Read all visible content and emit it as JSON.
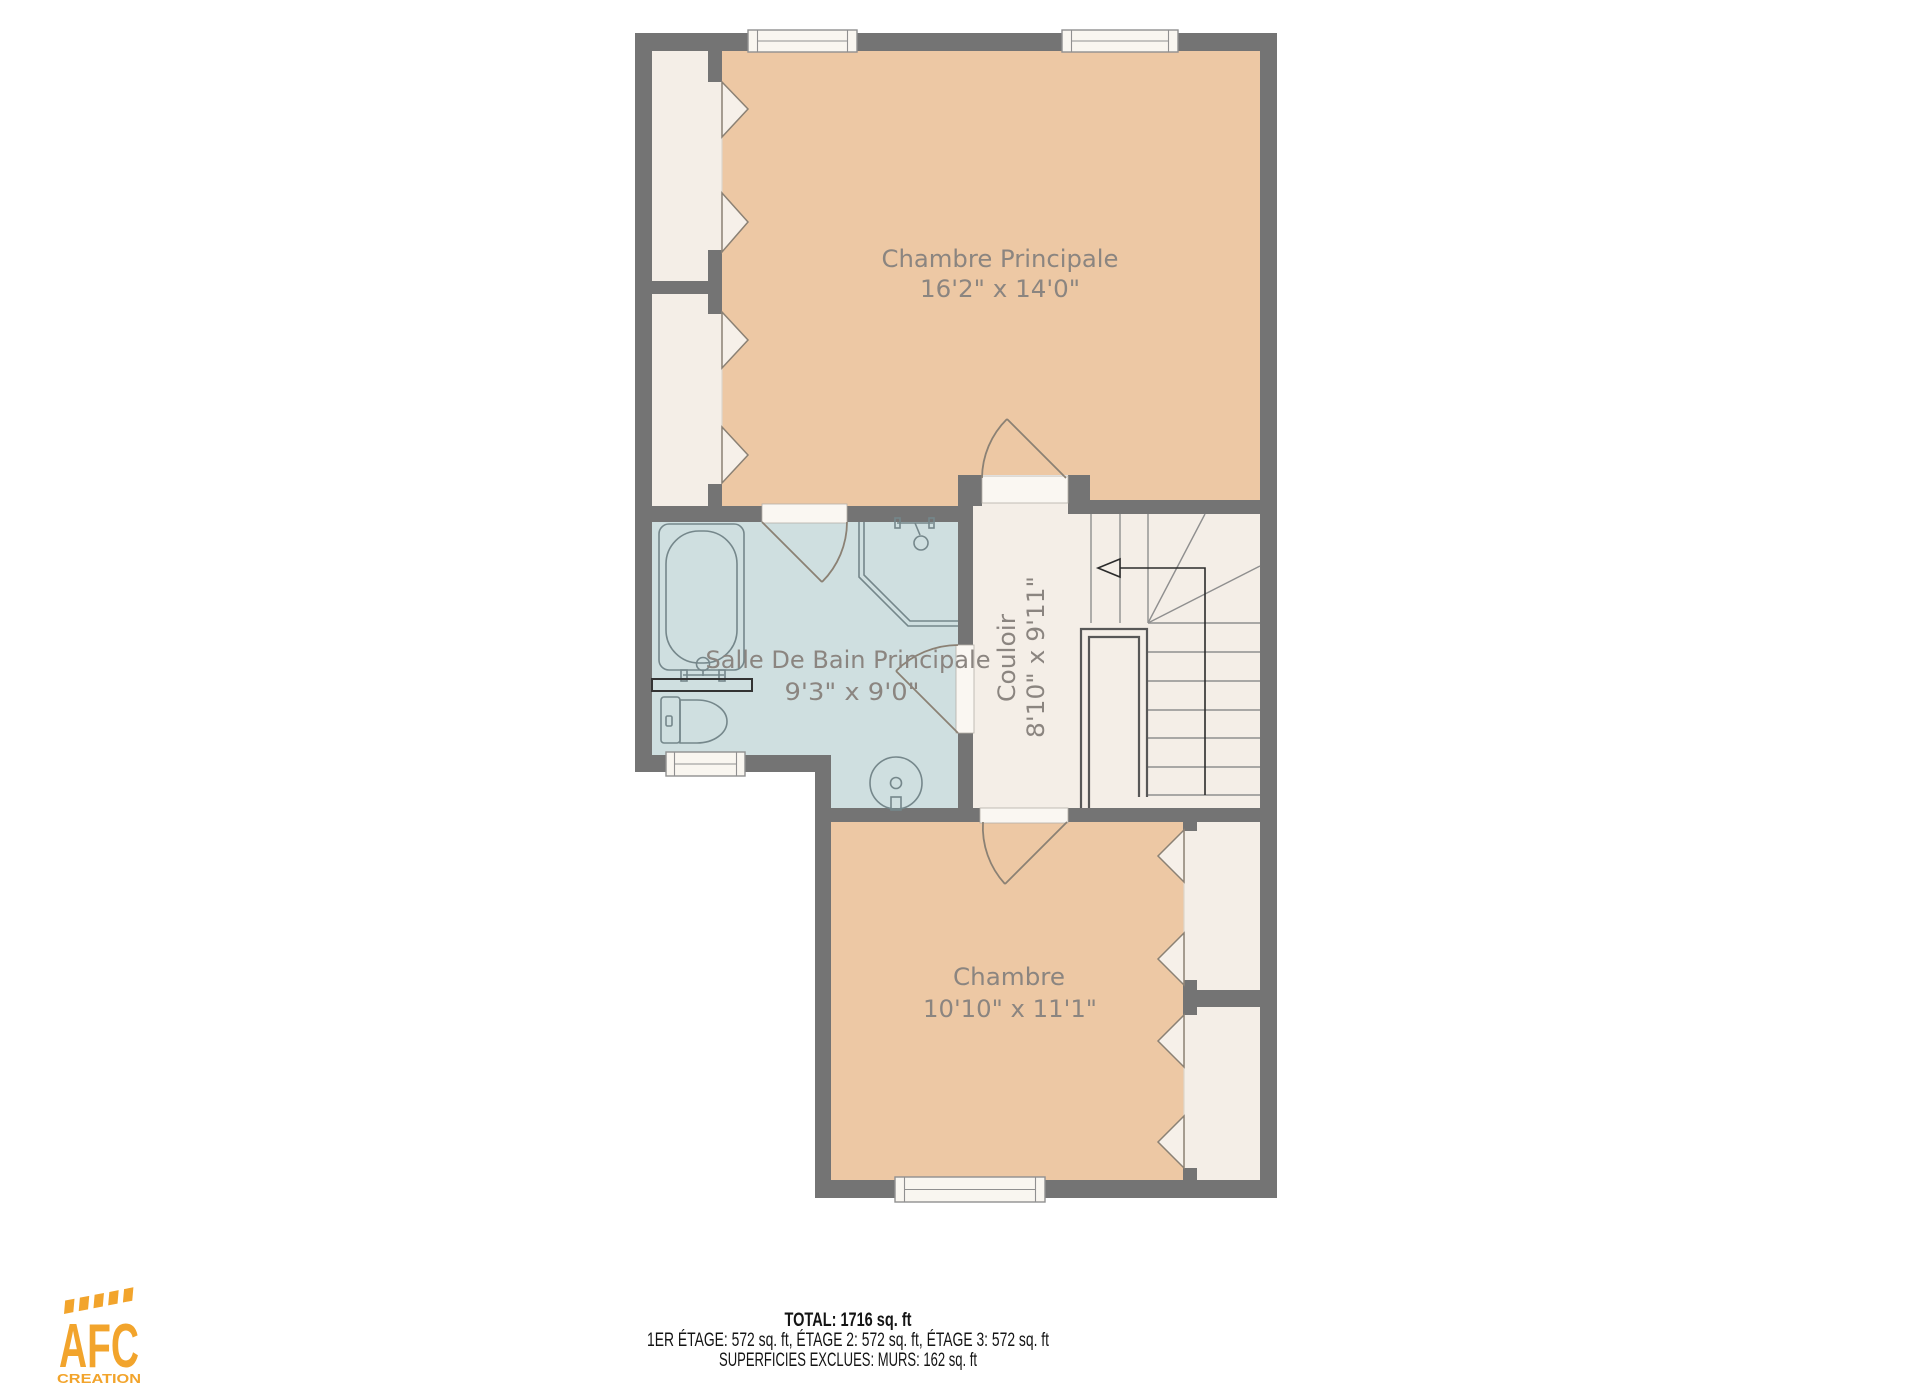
{
  "floor_plan": {
    "rooms": [
      {
        "id": "chambre-principale",
        "name": "Chambre Principale",
        "dimensions": "16'2\" x 14'0\""
      },
      {
        "id": "salle-de-bain-principale",
        "name": "Salle De Bain Principale",
        "dimensions": "9'3\" x 9'0\""
      },
      {
        "id": "couloir",
        "name": "Couloir",
        "dimensions": "8'10\" x 9'11\""
      },
      {
        "id": "chambre",
        "name": "Chambre",
        "dimensions": "10'10\" x 11'1\""
      }
    ],
    "stairs": {
      "direction_icon": "up-arrow-left"
    },
    "colors": {
      "wall": "#747474",
      "bedroom_fill": "#edc8a4",
      "bathroom_fill": "#cfdfe0",
      "hallway_fill": "#f4eee7",
      "label_text": "#8b8580"
    }
  },
  "footer": {
    "total": "TOTAL: 1716 sq. ft",
    "floors": "1ER ÉTAGE: 572 sq. ft, ÉTAGE 2: 572 sq. ft, ÉTAGE 3: 572 sq. ft",
    "exclusions": "SUPERFICIES EXCLUES: MURS: 162 sq. ft"
  },
  "logo": {
    "acronym": "AFC",
    "subtitle": "CREATION",
    "color": "#F2A42C"
  }
}
